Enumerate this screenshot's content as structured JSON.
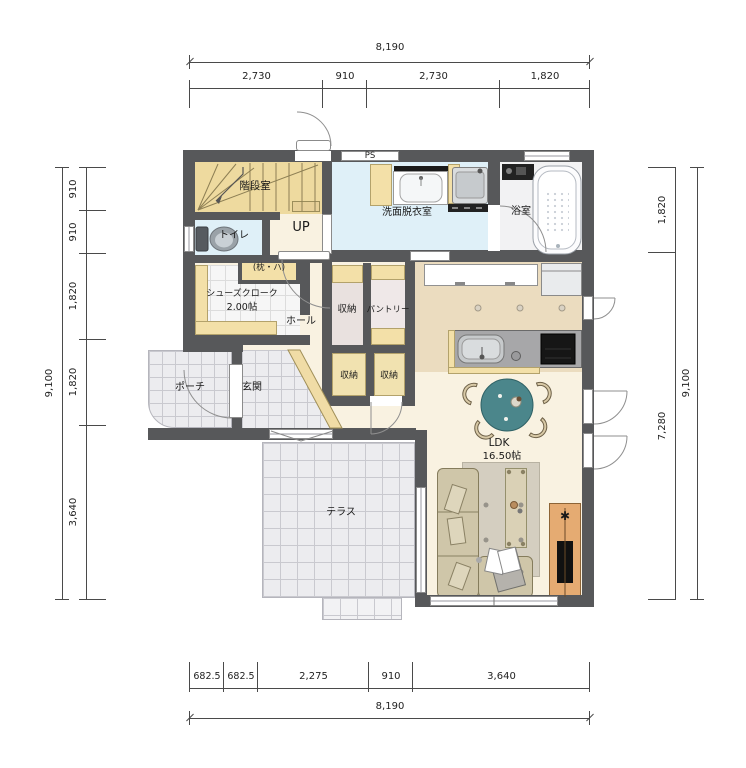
{
  "rooms": {
    "stairwell": "階段室",
    "toilet": "トイレ",
    "washroom": "洗面脱衣室",
    "bathroom": "浴室",
    "shelf_note": "(枕・ハ)",
    "shoe_closet": "シューズクローク",
    "shoe_closet_size": "2.00帖",
    "hall": "ホール",
    "closet": "収納",
    "pantry": "パントリー",
    "closet_small_left": "収納",
    "closet_small_right": "収納",
    "entrance": "玄関",
    "porch": "ポーチ",
    "terrace": "テラス",
    "ldk": "LDK",
    "ldk_size": "16.50帖"
  },
  "annotations": {
    "up": "UP",
    "ps": "PS",
    "tv_marker": "✱"
  },
  "dimensions": {
    "top": {
      "total": "8,190",
      "segments": [
        "2,730",
        "910",
        "2,730",
        "1,820"
      ]
    },
    "bottom": {
      "total": "8,190",
      "segments": [
        "682.5",
        "682.5",
        "2,275",
        "910",
        "3,640"
      ]
    },
    "left": {
      "total": "9,100",
      "segments": [
        "910",
        "910",
        "1,820",
        "1,820",
        "3,640"
      ]
    },
    "right": {
      "total": "9,100",
      "segments": [
        "1,820",
        "7,280"
      ]
    }
  },
  "colors": {
    "wall": "#57585a",
    "floor-main": "#f9f2e1",
    "floor-kitchen": "#ebdcbf",
    "floor-stair": "#eeda9f",
    "floor-water": "#dff0f8",
    "floor-bath": "#f2f2f3",
    "floor-closet": "#e9e1df",
    "floor-pantry": "#efe8e8",
    "cabinet": "#f3e0a8",
    "tile": "#ececef",
    "table": "#4b868b",
    "chair": "#d8c9a6",
    "sofa": "#cfc6a9",
    "tv-board": "#e5ab72",
    "dim-line": "#4a4a4a"
  }
}
